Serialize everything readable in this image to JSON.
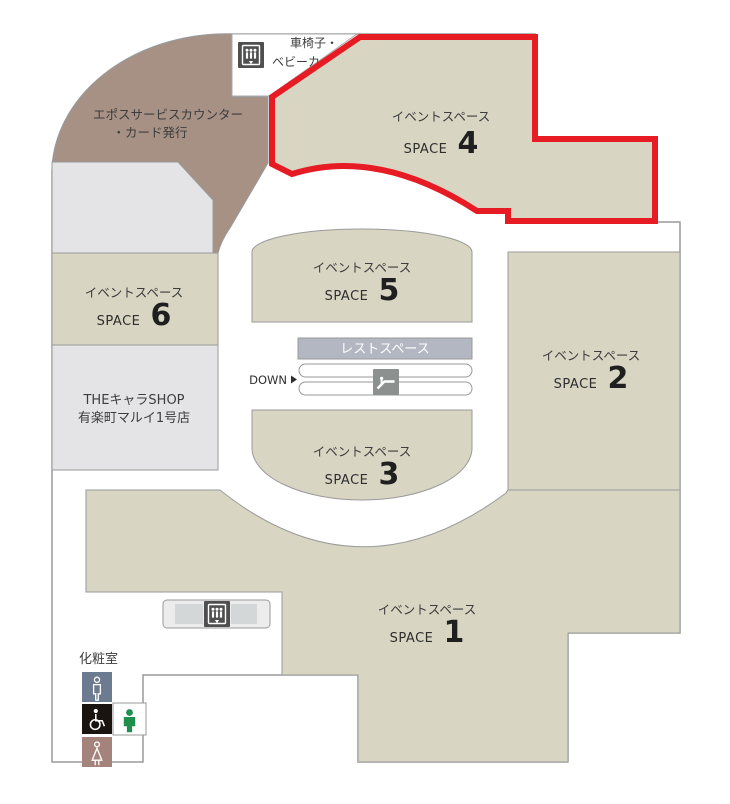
{
  "map": {
    "elevator_top": {
      "line1": "車椅子・",
      "line2": "ベビーカー専用"
    },
    "epos": {
      "line1": "エポスサービスカウンター",
      "line2": "・カード発行"
    },
    "shop": {
      "line1": "THEキャラSHOP",
      "line2": "有楽町マルイ1号店"
    },
    "space1": {
      "title": "イベントスペース",
      "space_label": "SPACE",
      "number": "1"
    },
    "space2": {
      "title": "イベントスペース",
      "space_label": "SPACE",
      "number": "2"
    },
    "space3": {
      "title": "イベントスペース",
      "space_label": "SPACE",
      "number": "3"
    },
    "space4": {
      "title": "イベントスペース",
      "space_label": "SPACE",
      "number": "4"
    },
    "space5": {
      "title": "イベントスペース",
      "space_label": "SPACE",
      "number": "5"
    },
    "space6": {
      "title": "イベントスペース",
      "space_label": "SPACE",
      "number": "6"
    },
    "rest_space": {
      "label": "レストスペース"
    },
    "escalator": {
      "down_label": "DOWN"
    },
    "restroom": {
      "label": "化粧室"
    },
    "icons": {
      "top_elevator": "elevator-icon",
      "bottom_elevator": "elevator-icon",
      "escalator": "escalator-icon",
      "men": "men-restroom-icon",
      "wheelchair": "wheelchair-restroom-icon",
      "baby_care": "baby-care-icon",
      "women": "women-restroom-icon"
    },
    "colors": {
      "highlight": "#e61b23",
      "space": "#d8d5c2",
      "counter": "#a69184",
      "gray_area": "#e4e4e6",
      "rest_bar": "#b2b7c1",
      "men_icon_bg": "#6d7b90",
      "wheelchair_icon_bg": "#1a1410",
      "women_icon_bg": "#a5837d",
      "baby_icon_green": "#1f8f4d",
      "elevator_icon_bg": "#4f4f4f",
      "escalator_icon_bg": "#8c918f"
    }
  }
}
